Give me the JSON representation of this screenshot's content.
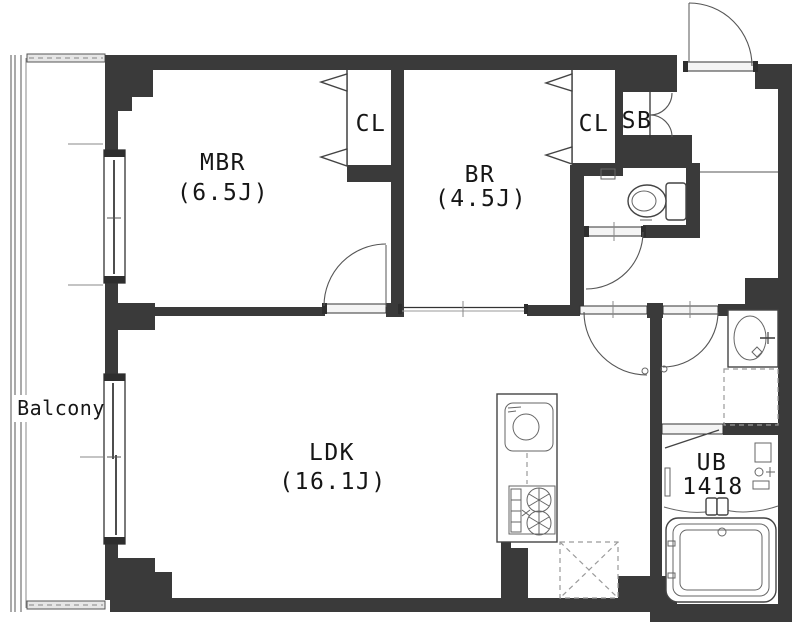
{
  "plan": {
    "balcony_label": "Balcony",
    "rooms": {
      "mbr": {
        "name": "MBR",
        "size": "(6.5J)"
      },
      "br": {
        "name": "BR",
        "size": "(4.5J)"
      },
      "ldk": {
        "name": "LDK",
        "size": "(16.1J)"
      },
      "ub": {
        "name": "UB",
        "size": "1418"
      },
      "closet_mbr": {
        "label": "CL"
      },
      "closet_br": {
        "label": "CL"
      },
      "shoe_box": {
        "label": "SB"
      }
    },
    "colors": {
      "wall": "#3a3a3a",
      "line": "#333333",
      "background": "#ffffff"
    }
  }
}
